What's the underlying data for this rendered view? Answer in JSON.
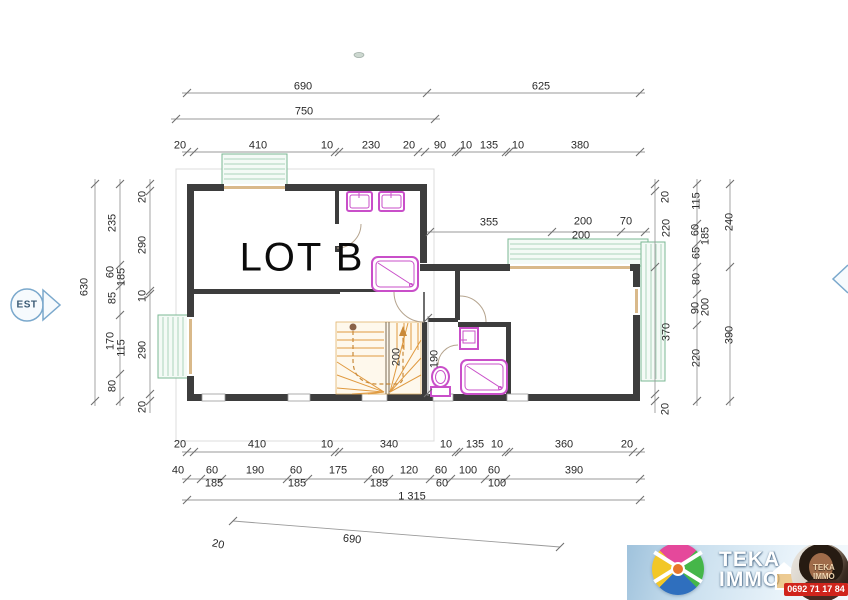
{
  "page": {
    "title_label": "LOT B"
  },
  "compass": {
    "east_label": "EST"
  },
  "colors": {
    "wall": "#3d3d3d",
    "balcony": "#7bb894",
    "fixture": "#c94fc9",
    "stairs": "#e09a40",
    "dimension": "#9a9a9a",
    "compass": "#7aa8cc",
    "logo_red": "#d0241c"
  },
  "dimension_labels": {
    "top": [
      {
        "t": "690",
        "x": 303,
        "y": 87
      },
      {
        "t": "625",
        "x": 541,
        "y": 87
      },
      {
        "t": "750",
        "x": 304,
        "y": 112
      },
      {
        "t": "20",
        "x": 180,
        "y": 146
      },
      {
        "t": "410",
        "x": 258,
        "y": 146
      },
      {
        "t": "10",
        "x": 327,
        "y": 146
      },
      {
        "t": "230",
        "x": 371,
        "y": 146
      },
      {
        "t": "20",
        "x": 409,
        "y": 146
      },
      {
        "t": "90",
        "x": 440,
        "y": 146
      },
      {
        "t": "10",
        "x": 466,
        "y": 146
      },
      {
        "t": "135",
        "x": 489,
        "y": 146
      },
      {
        "t": "10",
        "x": 518,
        "y": 146
      },
      {
        "t": "380",
        "x": 580,
        "y": 146
      }
    ],
    "interior": [
      {
        "t": "355",
        "x": 489,
        "y": 223
      },
      {
        "t": "200",
        "x": 583,
        "y": 222
      },
      {
        "t": "70",
        "x": 626,
        "y": 222
      },
      {
        "t": "200",
        "x": 581,
        "y": 236
      },
      {
        "t": "200",
        "x": 397,
        "y": 357,
        "r": -90
      },
      {
        "t": "190",
        "x": 435,
        "y": 359,
        "r": -90
      }
    ],
    "bottom": [
      {
        "t": "20",
        "x": 180,
        "y": 445
      },
      {
        "t": "410",
        "x": 257,
        "y": 445
      },
      {
        "t": "10",
        "x": 327,
        "y": 445
      },
      {
        "t": "340",
        "x": 389,
        "y": 445
      },
      {
        "t": "10",
        "x": 446,
        "y": 445
      },
      {
        "t": "135",
        "x": 475,
        "y": 445
      },
      {
        "t": "10",
        "x": 497,
        "y": 445
      },
      {
        "t": "360",
        "x": 564,
        "y": 445
      },
      {
        "t": "20",
        "x": 627,
        "y": 445
      },
      {
        "t": "40",
        "x": 178,
        "y": 471
      },
      {
        "t": "60",
        "x": 212,
        "y": 471
      },
      {
        "t": "190",
        "x": 255,
        "y": 471
      },
      {
        "t": "60",
        "x": 296,
        "y": 471
      },
      {
        "t": "175",
        "x": 338,
        "y": 471
      },
      {
        "t": "60",
        "x": 378,
        "y": 471
      },
      {
        "t": "120",
        "x": 409,
        "y": 471
      },
      {
        "t": "60",
        "x": 441,
        "y": 471
      },
      {
        "t": "100",
        "x": 468,
        "y": 471
      },
      {
        "t": "60",
        "x": 494,
        "y": 471
      },
      {
        "t": "390",
        "x": 574,
        "y": 471
      },
      {
        "t": "185",
        "x": 214,
        "y": 484
      },
      {
        "t": "185",
        "x": 297,
        "y": 484
      },
      {
        "t": "185",
        "x": 379,
        "y": 484
      },
      {
        "t": "60",
        "x": 442,
        "y": 484
      },
      {
        "t": "100",
        "x": 497,
        "y": 484
      },
      {
        "t": "1 315",
        "x": 412,
        "y": 497
      },
      {
        "t": "690",
        "x": 352,
        "y": 540,
        "r": 6
      },
      {
        "t": "20",
        "x": 218,
        "y": 545,
        "r": 12
      }
    ],
    "left": [
      {
        "t": "630",
        "x": 85,
        "y": 287,
        "r": -90
      },
      {
        "t": "235",
        "x": 113,
        "y": 223,
        "r": -90
      },
      {
        "t": "60",
        "x": 111,
        "y": 272,
        "r": -90
      },
      {
        "t": "185",
        "x": 122,
        "y": 277,
        "r": -90
      },
      {
        "t": "85",
        "x": 113,
        "y": 298,
        "r": -90
      },
      {
        "t": "170",
        "x": 111,
        "y": 341,
        "r": -90
      },
      {
        "t": "115",
        "x": 122,
        "y": 348,
        "r": -90
      },
      {
        "t": "80",
        "x": 113,
        "y": 386,
        "r": -90
      },
      {
        "t": "20",
        "x": 143,
        "y": 197,
        "r": -90
      },
      {
        "t": "290",
        "x": 143,
        "y": 245,
        "r": -90
      },
      {
        "t": "10",
        "x": 143,
        "y": 296,
        "r": -90
      },
      {
        "t": "290",
        "x": 143,
        "y": 350,
        "r": -90
      },
      {
        "t": "20",
        "x": 143,
        "y": 407,
        "r": -90
      }
    ],
    "right": [
      {
        "t": "20",
        "x": 666,
        "y": 197,
        "r": -90
      },
      {
        "t": "220",
        "x": 667,
        "y": 228,
        "r": -90
      },
      {
        "t": "370",
        "x": 667,
        "y": 332,
        "r": -90
      },
      {
        "t": "20",
        "x": 666,
        "y": 409,
        "r": -90
      },
      {
        "t": "115",
        "x": 697,
        "y": 201,
        "r": -90
      },
      {
        "t": "60",
        "x": 696,
        "y": 230,
        "r": -90
      },
      {
        "t": "185",
        "x": 706,
        "y": 236,
        "r": -90
      },
      {
        "t": "65",
        "x": 697,
        "y": 253,
        "r": -90
      },
      {
        "t": "80",
        "x": 697,
        "y": 279,
        "r": -90
      },
      {
        "t": "90",
        "x": 696,
        "y": 308,
        "r": -90
      },
      {
        "t": "200",
        "x": 706,
        "y": 307,
        "r": -90
      },
      {
        "t": "220",
        "x": 697,
        "y": 358,
        "r": -90
      },
      {
        "t": "240",
        "x": 730,
        "y": 222,
        "r": -90
      },
      {
        "t": "390",
        "x": 730,
        "y": 335,
        "r": -90
      }
    ]
  },
  "logo": {
    "brand_line1": "TEKA",
    "brand_line2": "IMMO",
    "watermark_line1": "TEKA",
    "watermark_line2": "IMMO",
    "phone": "0692 71 17 84"
  }
}
